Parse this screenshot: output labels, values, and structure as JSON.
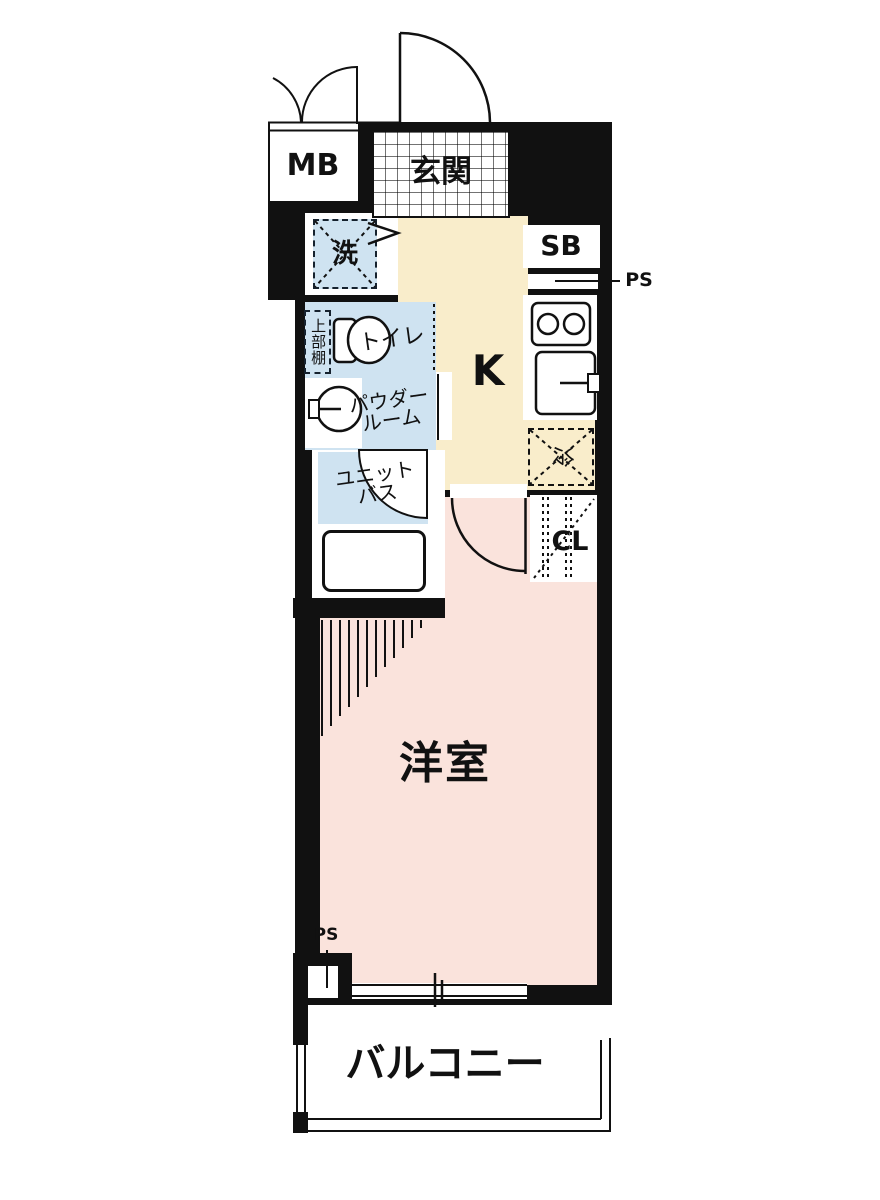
{
  "plan": {
    "type": "apartment-floor-plan",
    "labels": {
      "mb": "MB",
      "entrance": "玄関",
      "washer": "洗",
      "shoe_box": "SB",
      "pipe_space_top": "PS",
      "upper_shelf": "上部棚",
      "toilet": "トイレ",
      "powder_room_line1": "パウダー",
      "powder_room_line2": "ルーム",
      "kitchen": "K",
      "unit_bath_line1": "ユニット",
      "unit_bath_line2": "バス",
      "refrigerator": "冷",
      "closet": "CL",
      "western_room": "洋室",
      "pipe_space_bottom": "PS",
      "balcony": "バルコニー"
    },
    "colors": {
      "wall": "#111111",
      "room_pink": "#fae3dc",
      "kitchen_cream": "#f9edcb",
      "wet_blue": "#cfe3f1",
      "background": "#ffffff"
    }
  }
}
